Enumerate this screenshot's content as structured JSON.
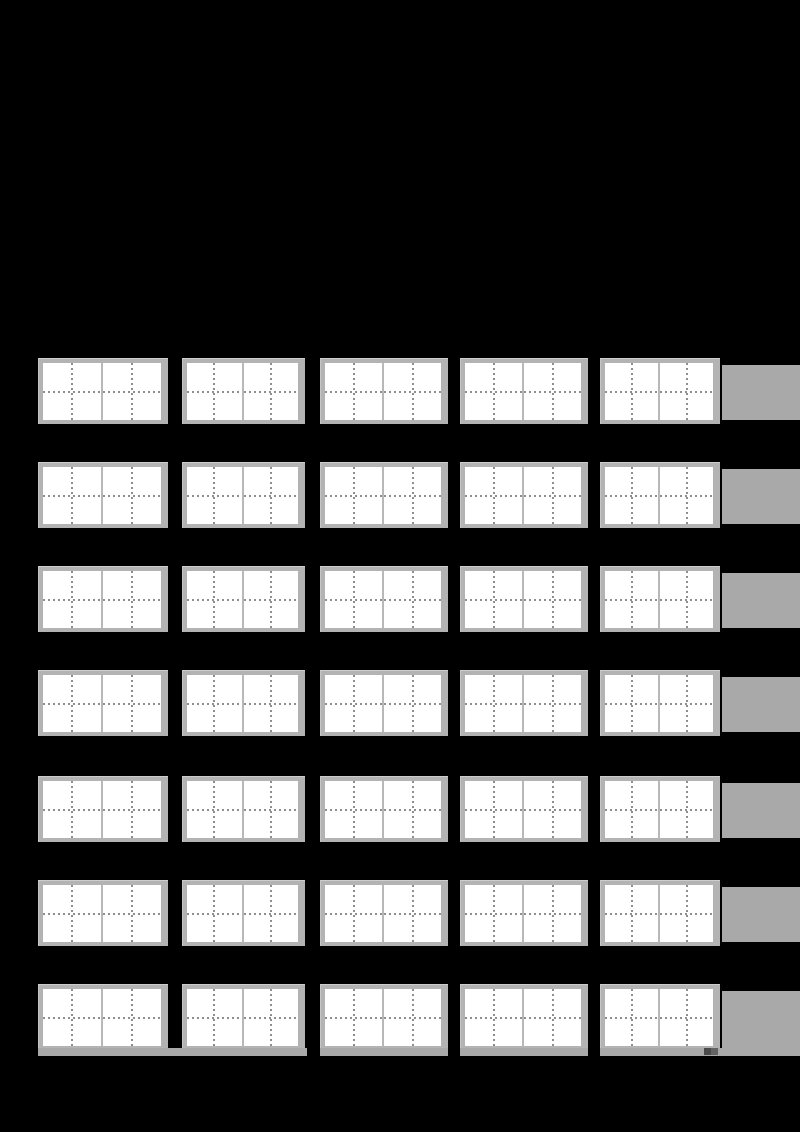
{
  "page": {
    "width": 800,
    "height": 1132,
    "background": "#000000",
    "description": "blank handwriting practice worksheet on black page, no visible text"
  },
  "colors": {
    "box_frame": "#b3b3b3",
    "box_frame_highlight": "#cdcdcd",
    "cell_background": "#ffffff",
    "cell_divider": "#b8b8b8",
    "dashed_guide": "#8e8e8e",
    "right_strip": "#a9a9a9",
    "bottom_band": "#a9a9a9",
    "handle_dark": "#4a4a4a",
    "handle_light": "#636363"
  },
  "grid": {
    "rows": 7,
    "cols": 5,
    "cells_per_box": 2,
    "row_tops": [
      358,
      462,
      566,
      670,
      776,
      880,
      984
    ],
    "box_height": 66,
    "columns": [
      {
        "x": 38,
        "w": 130
      },
      {
        "x": 182,
        "w": 123
      },
      {
        "x": 320,
        "w": 128
      },
      {
        "x": 460,
        "w": 128
      },
      {
        "x": 600,
        "w": 120
      }
    ]
  },
  "right_strips": {
    "x": 722,
    "w": 78,
    "offset_top": 7,
    "height": 55,
    "last_row_height": 62
  },
  "bottom_band": {
    "y": 1048,
    "h": 8,
    "segments": [
      {
        "x": 38,
        "w": 269
      },
      {
        "x": 320,
        "w": 128
      },
      {
        "x": 460,
        "w": 128
      },
      {
        "x": 600,
        "w": 200
      }
    ]
  },
  "handle": {
    "x": 704,
    "y": 1048,
    "w": 14,
    "h": 7
  }
}
